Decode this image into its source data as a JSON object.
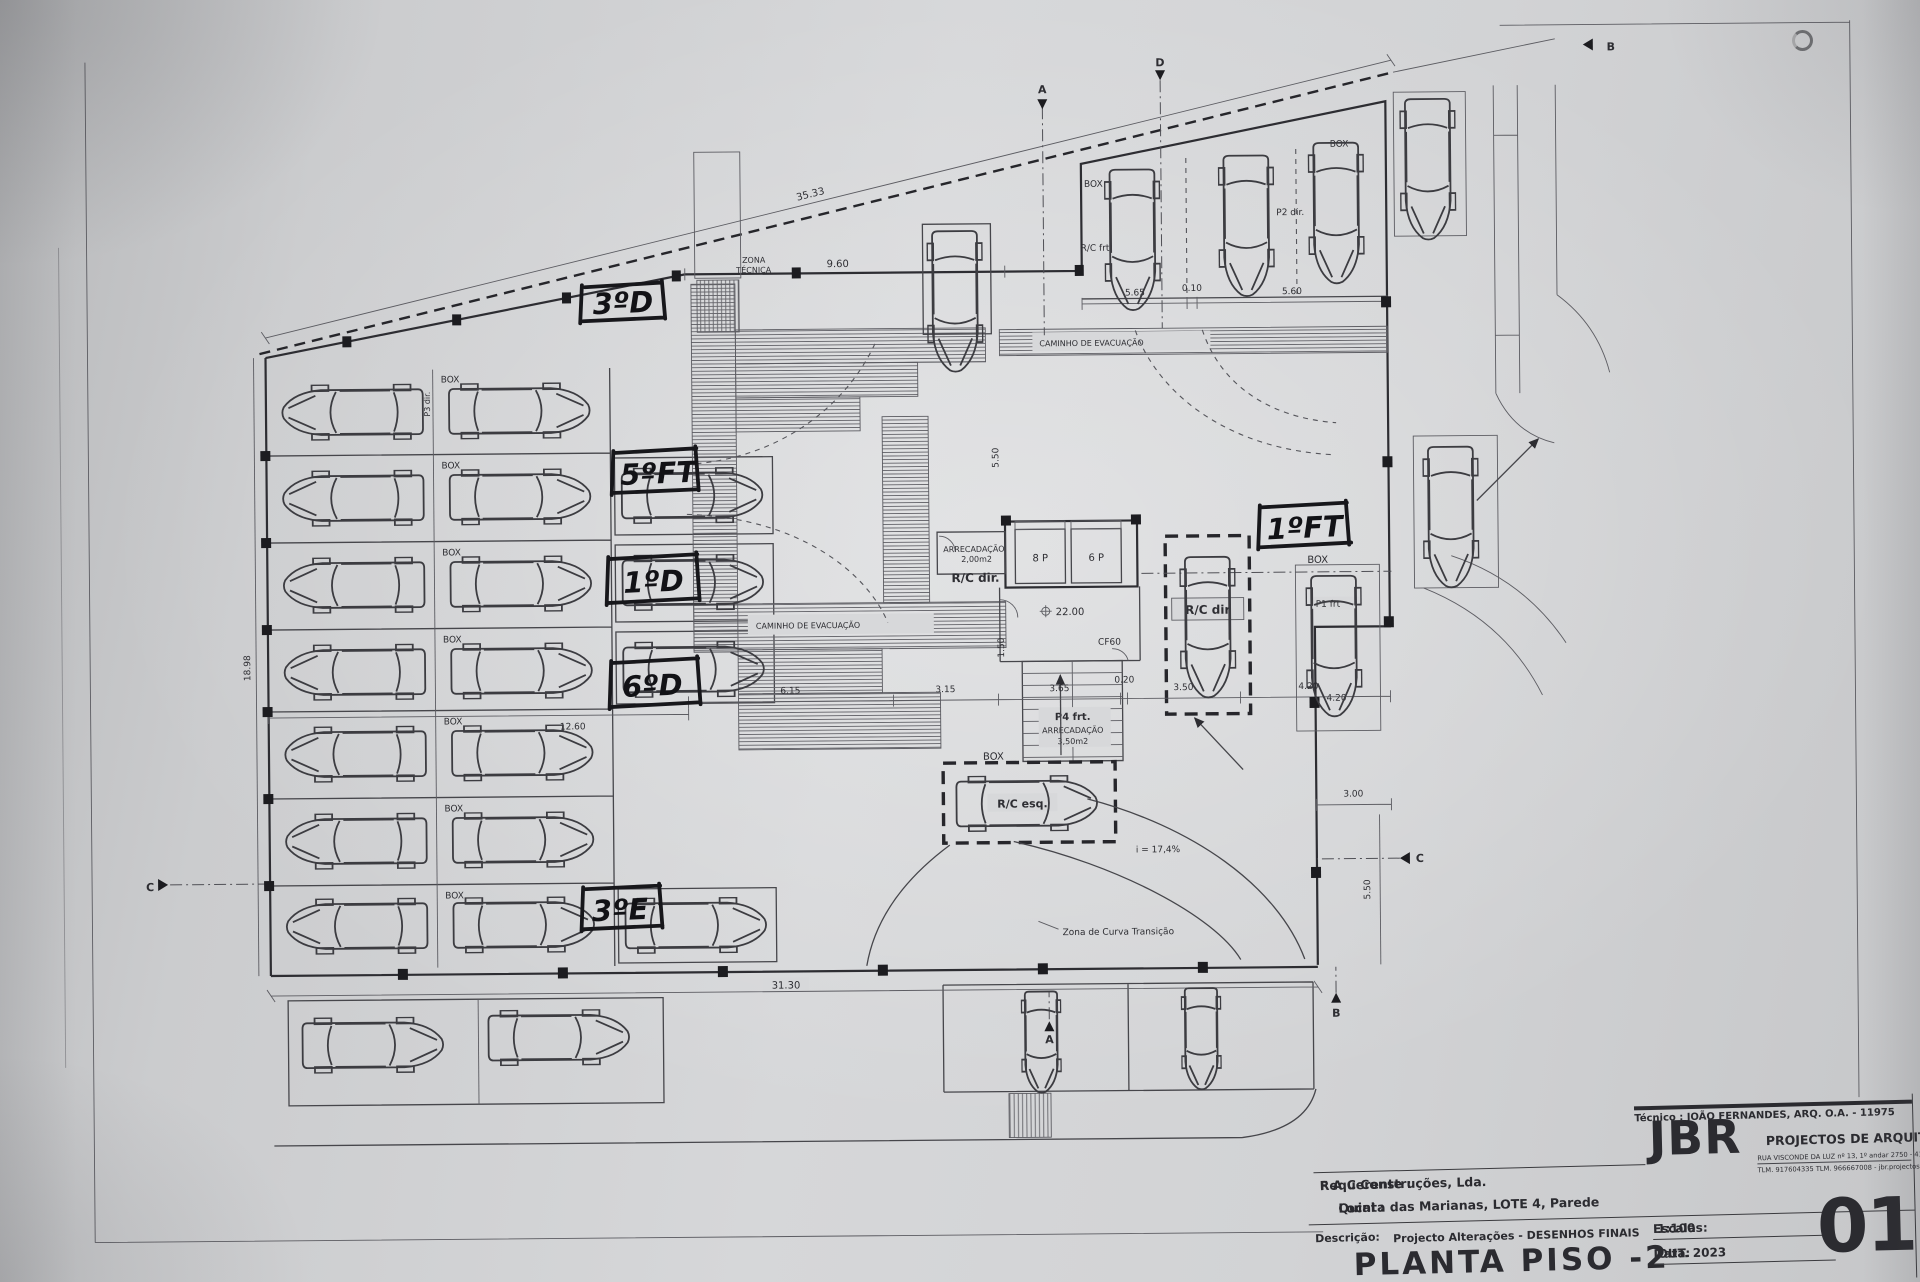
{
  "hand": [
    "3ºD",
    "5ºFT",
    "1ºD",
    "6ºD",
    "3ºE",
    "1ºFT"
  ],
  "labels": {
    "box": "BOX",
    "rc_frt": "R/C frt",
    "rc_dir": "R/C dir.",
    "rc_dir_spot": "R/C dir",
    "rc_esq": "R/C esq.",
    "p2_dir": "P2 dir.",
    "p3_dir": "P3 dir.",
    "p1_frt": "P1 frt",
    "p4_frt": "P4 frt.",
    "zona_l1": "ZONA",
    "zona_l2": "TÉCNICA",
    "caminho": "CAMINHO  DE  EVACUAÇÃO",
    "arrec": "ARRECADAÇÃO",
    "arrec_a1": "2,00m2",
    "arrec_a2": "3,50m2",
    "lift_8p": "8 P",
    "lift_6p": "6 P",
    "cf60": "CF60",
    "level": "22.00",
    "slope": "i = 17,4%",
    "curva": "Zona de Curva Transição"
  },
  "dims": {
    "top": "35.33",
    "d960": "9.60",
    "bottom": "31.30",
    "d565": "5.65",
    "d010": "0.10",
    "d560": "5.60",
    "d1260": "12.60",
    "d615": "6.15",
    "d315": "3.15",
    "d365": "3.65",
    "d020": "0.20",
    "d350": "3.50",
    "d420": "4.20",
    "d300": "3.00",
    "d550": "5.50",
    "d150": "1.50",
    "d1898": "18.98"
  },
  "sections": {
    "a": "A",
    "b": "B",
    "c": "C",
    "d": "D"
  },
  "title_block": {
    "tecnico": "Técnico : JOÃO FERNANDES, ARQ.   O.A. - 11975",
    "firm": "JBR",
    "firm_tagline": "PROJECTOS DE ARQUITECTURA",
    "firm_address": "RUA VISCONDE DA LUZ nº 13, 1º andar  2750 - 416  CASCAIS",
    "firm_contact": "TLM. 917604335  TLM. 966667008 - jbr.projectos@gmail.com",
    "requerente_label": "Requerente :",
    "requerente": "F A C  Construções, Lda.",
    "local_label": "Local :",
    "local": "Quinta das Marianas, LOTE 4, Parede",
    "descricao_label": "Descrição:",
    "descricao": "Projecto Alterações - DESENHOS FINAIS",
    "title": "PLANTA PISO -2",
    "escalas_label": "Escalas:",
    "escalas": "1:100",
    "data_label": "Data:",
    "data": "OUT. 2023",
    "sheet": "01"
  }
}
